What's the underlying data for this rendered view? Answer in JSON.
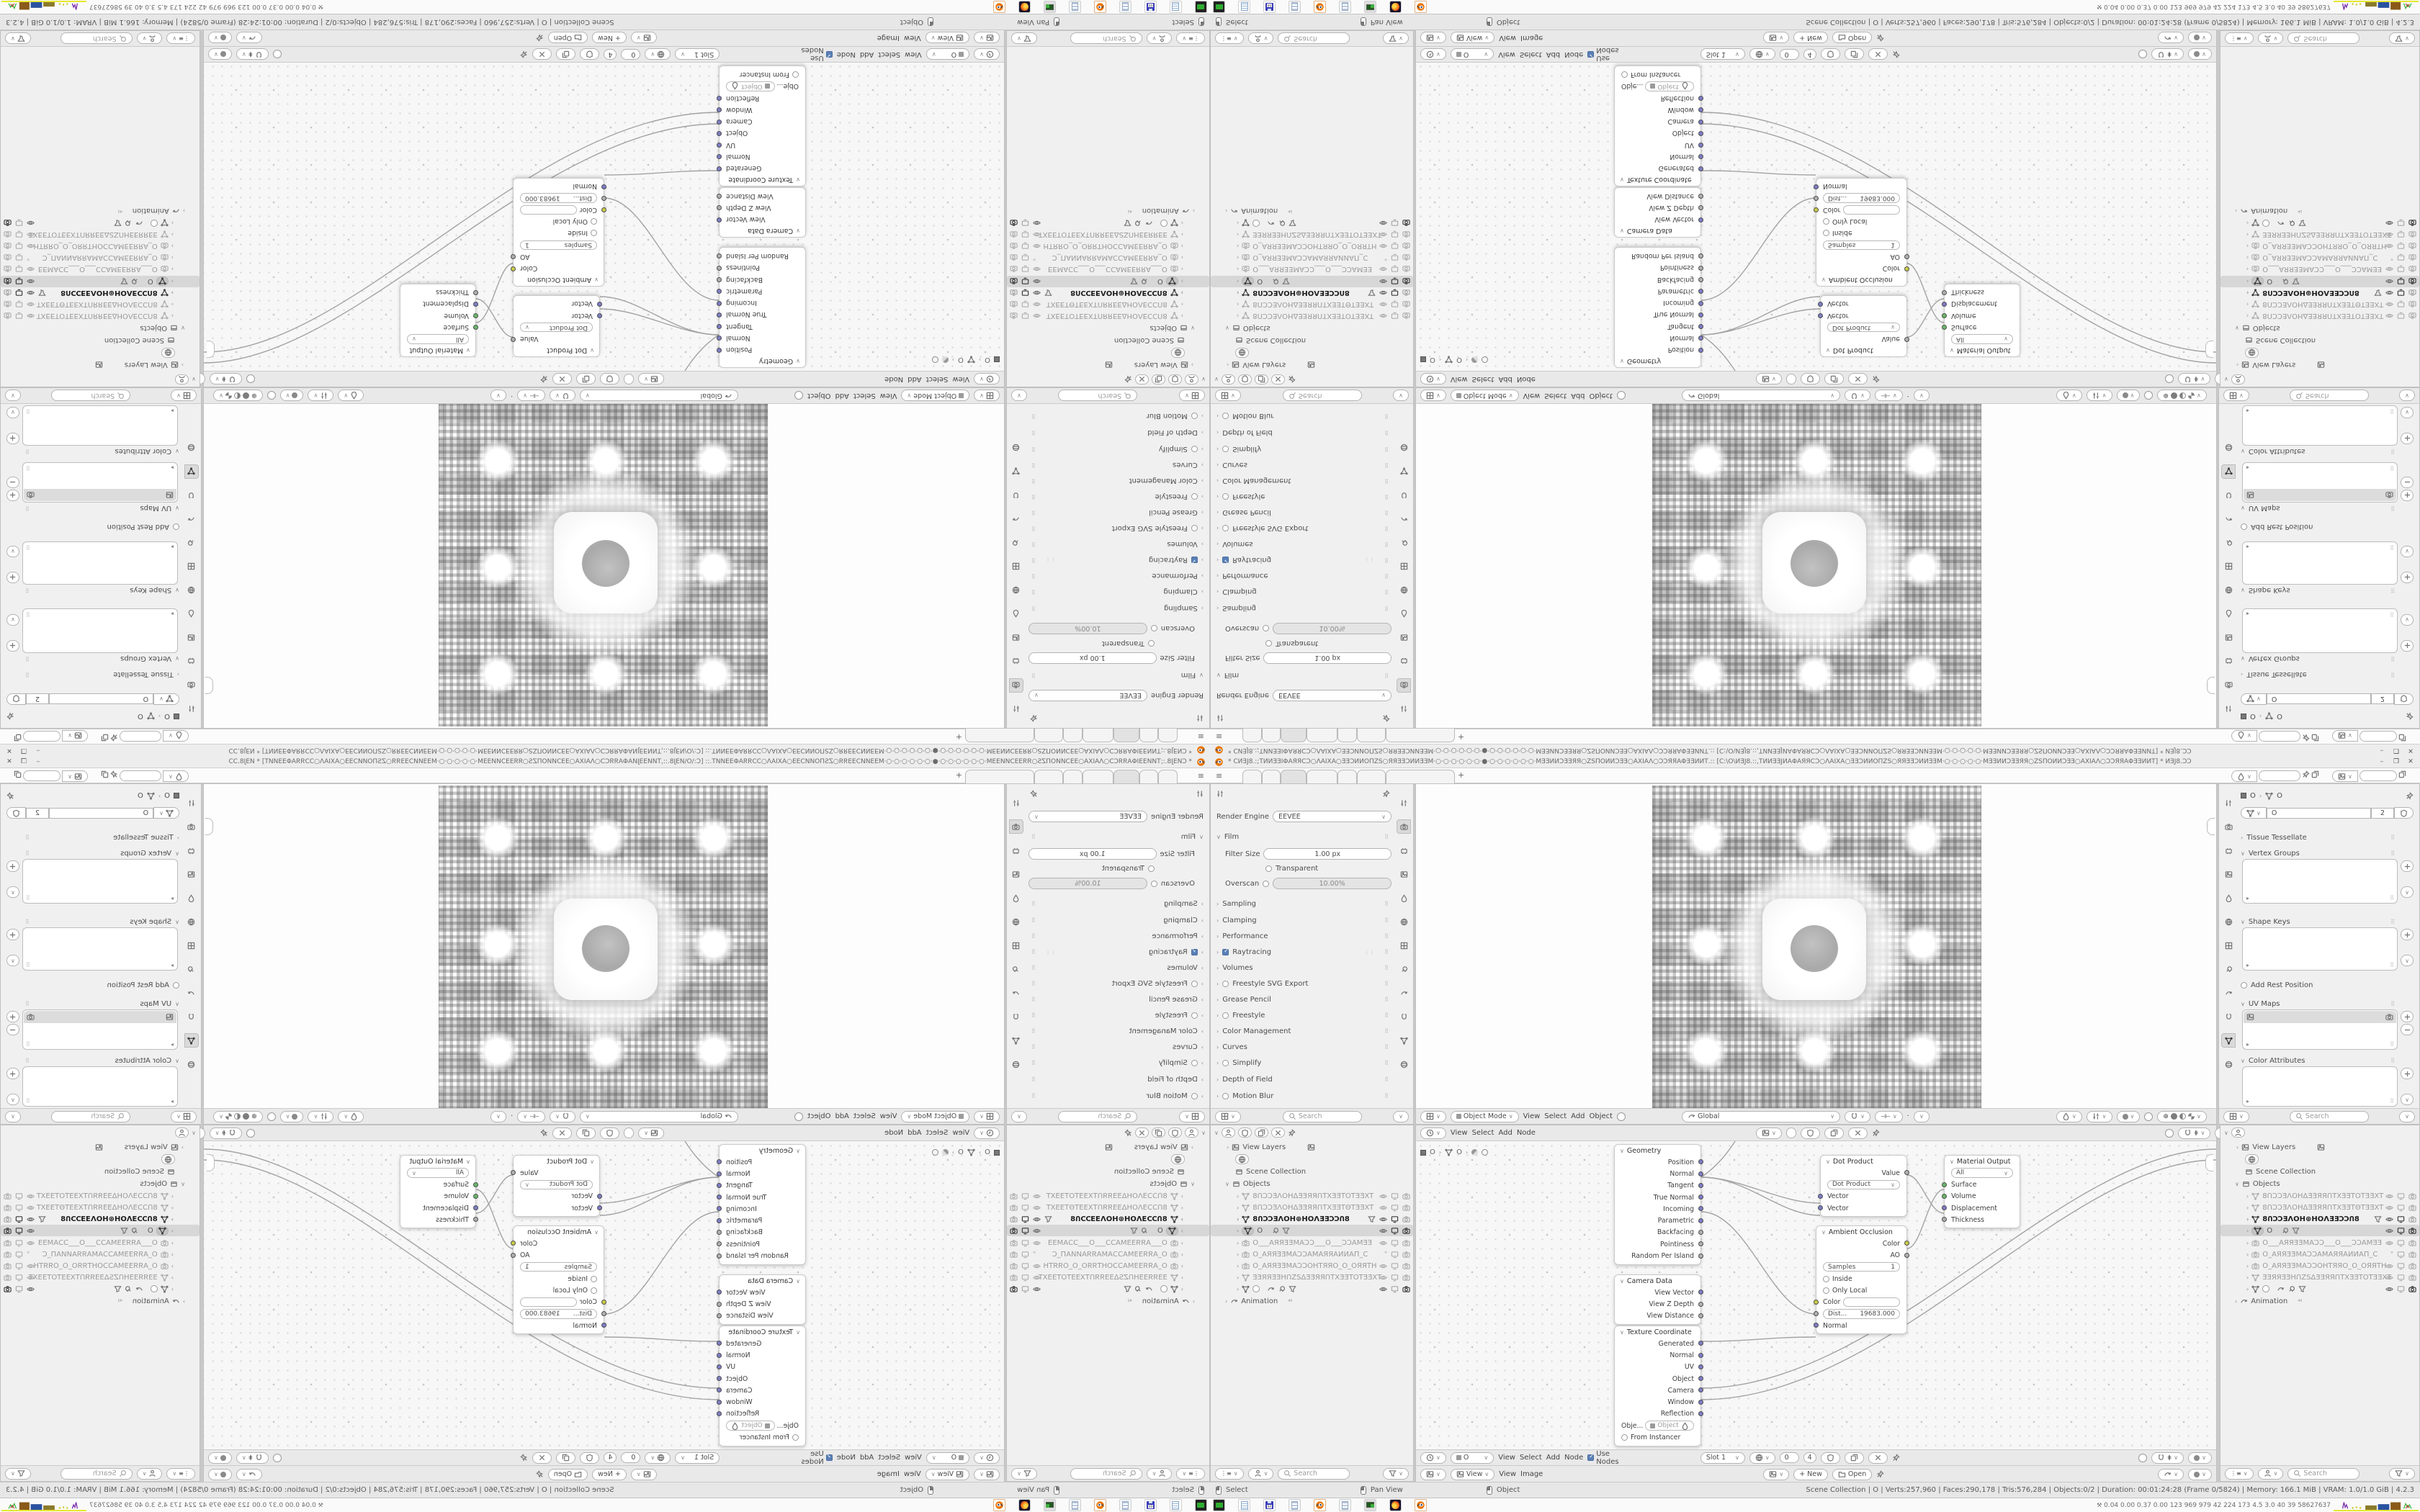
{
  "window": {
    "title": "* ϹИƎJ8.:;ТИИƎƎІΦАЯЯϹϽ○ΛАІХА○ƎƎϽИИОΠΖS○ЯЯƎƎϽИИƎƎМ·○·○·○·○·○·○·●·○·○·○·○·○·○·МƎƎИИϽƎƎЯЯ○ΖSΠОИИϽƎƎ○АХІАΛ○ϽϽЯЯАΦƎƎИИТ.:: [Ϲ:\\О\\ИƎJ8.::,ТИИƎƎJИАΦАЯЯϹϽ○ΛАІХА○ƎƎϽИИОΠΖS○ЯЯƎƎϽИИƎƎМ·○·○·○·○·○·МƎƎИИϽƎƎЯЯ○ΖSΠОИИϽƎƎ○АХІАΛ○ϽϽЯЯАΦƎƎИИТ] * ИƎJ8.ϽϽ",
    "minimize": "–",
    "maximize": "❐",
    "close": "✕",
    "new_tab": "+"
  },
  "render_props": {
    "render_engine_label": "Render Engine",
    "render_engine_value": "EEVEE",
    "film_label": "Film",
    "filter_size_label": "Filter Size",
    "filter_size_value": "1.00 px",
    "transparent_label": "Transparent",
    "overscan_label": "Overscan",
    "overscan_value": "10.00%",
    "sections": [
      "Sampling",
      "Clamping",
      "Performance",
      "Raytracing",
      "Volumes",
      "Freestyle SVG Export",
      "Grease Pencil",
      "Freestyle",
      "Color Management",
      "Curves",
      "Simplify",
      "Depth of Field",
      "Motion Blur"
    ],
    "search_placeholder": "Search"
  },
  "viewport": {
    "mode": "Object Mode",
    "menu": [
      "View",
      "Select",
      "Add",
      "Object"
    ],
    "orientation": "Global"
  },
  "node_editor": {
    "menu": [
      "View",
      "Select",
      "Add",
      "Node"
    ],
    "crumb_object": "O",
    "crumb_data": "O",
    "use_nodes": "Use Nodes",
    "slot": "Slot 1",
    "users_count": "4",
    "name_value": "0",
    "nodes": {
      "geometry": {
        "title": "Geometry",
        "outputs": [
          "Position",
          "Normal",
          "Tangent",
          "True Normal",
          "Incoming",
          "Parametric",
          "Backfacing",
          "Pointiness",
          "Random Per Island"
        ]
      },
      "camera_data": {
        "title": "Camera Data",
        "outputs": [
          "View Vector",
          "View Z Depth",
          "View Distance"
        ]
      },
      "texture_coordinate": {
        "title": "Texture Coordinate",
        "outputs": [
          "Generated",
          "Normal",
          "UV",
          "Object",
          "Camera",
          "Window",
          "Reflection"
        ],
        "object_label": "Obje...",
        "object_value": "Object",
        "from_instancer": "From Instancer"
      },
      "dot_product": {
        "title": "Dot Product",
        "output": "Value",
        "operation": "Dot Product",
        "input1": "Vector",
        "input2": "Vector"
      },
      "material_output": {
        "title": "Material Output",
        "target": "All",
        "inputs": [
          "Surface",
          "Volume",
          "Displacement",
          "Thickness"
        ]
      },
      "ambient_occlusion": {
        "title": "Ambient Occlusion",
        "out_color": "Color",
        "out_ao": "AO",
        "samples_label": "Samples",
        "samples_value": "1",
        "inside": "Inside",
        "only_local": "Only Local",
        "color_label": "Color",
        "distance_label": "Dist...",
        "distance_value": "19683.000",
        "normal": "Normal"
      }
    }
  },
  "image_editor": {
    "view_value": "View",
    "menu": [
      "View",
      "Image"
    ],
    "new_label": "+ New",
    "open_label": "Open"
  },
  "object_props": {
    "crumb_object": "O",
    "crumb_data": "O",
    "name_value": "O",
    "users_count": "2",
    "tissue": "Tissue Tessellate",
    "vertex_groups": "Vertex Groups",
    "shape_keys": "Shape Keys",
    "add_rest_position": "Add Rest Position",
    "uv_maps": "UV Maps",
    "color_attributes": "Color Attributes",
    "search_placeholder": "Search"
  },
  "outliner": {
    "view_layers": "View Layers",
    "scene_collection": "Scene Collection",
    "objects_label": "Objects",
    "animation": "Animation",
    "search_placeholder": "Search",
    "items": [
      {
        "label": "8ՈϽϽƎΛOHΔƎƎЯЯՈTXƎƎTOTƎƎXT"
      },
      {
        "label": "8ՈϽϽƎΛOHΔƎƎЯЯՈTXƎƎTΘTƎƎXT"
      },
      {
        "label": "8ՈϽϽƎΛOH⊕HOΛƎƎϽϽՈ8"
      },
      {
        "label": "O"
      },
      {
        "label": "O___АЯЯƎƎMАϽϽ___O___ϽϽАMƎƎ"
      },
      {
        "label": "O_АЯЯƎƎMАϽϽАMАЯЯАИИАП_Ϲ"
      },
      {
        "label": "O_АЯЯƎƎMАϽϽOHTЯЯO_O_OЯЯTH"
      },
      {
        "label": "ƎƎЯЯƎƎHՈΖSΔƎƎЯЯՈTXƎƎTOTƎƎXT"
      },
      {
        "label": ""
      }
    ]
  },
  "status_bar": {
    "hint_left": "Select",
    "hint_middle": "Pan View",
    "hint_right": "Object",
    "stats": "Scene Collection | O | Verts:257,960 | Faces:290,178 | Tris:576,284 | Objects:0/2 | Duration: 00:01:24:28 (Frame 0/5824) | Memory: 166.1 MiB | VRAM: 1.0/1.0 GiB | 4.2.3"
  },
  "taskbar": {
    "tray_text": "0.04 0.00 0.37 0.00  123  969  979  42  224  173  4.5  3.0  40  39 58627637"
  }
}
